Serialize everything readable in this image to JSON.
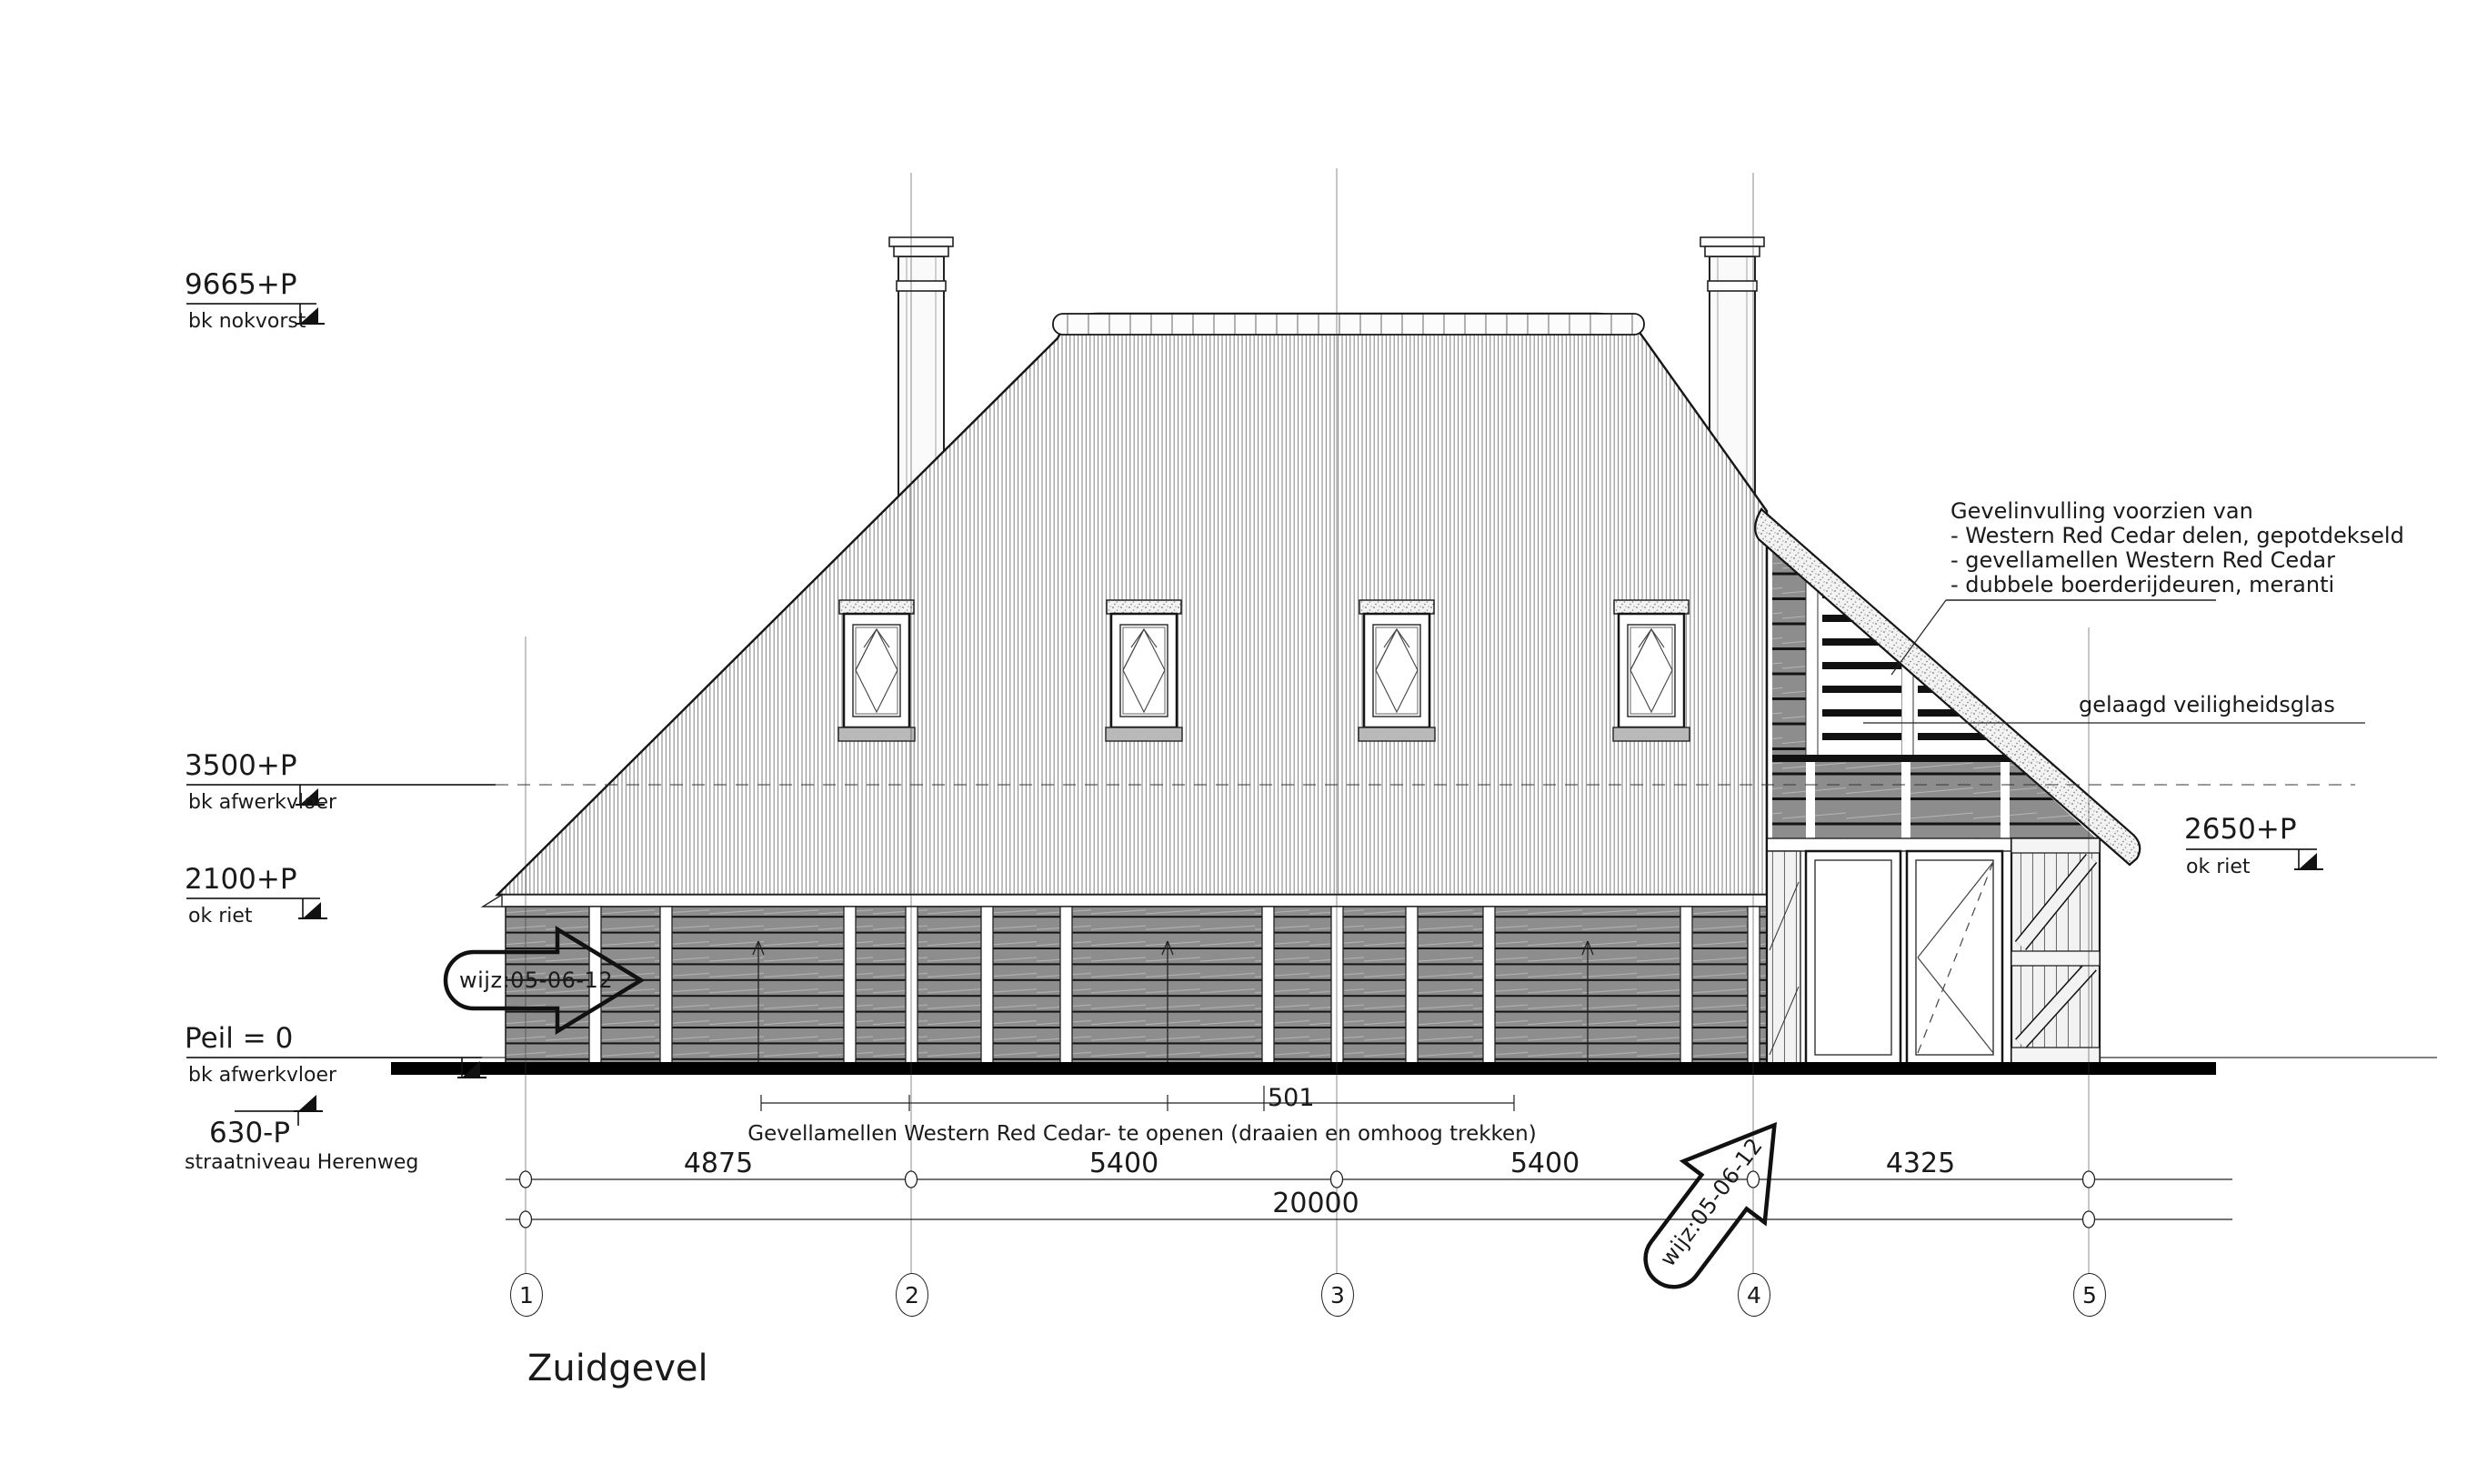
{
  "drawing_title": "Zuidgevel",
  "levels": {
    "nok": {
      "value": "9665+P",
      "label": "bk nokvorst"
    },
    "floor": {
      "value": "3500+P",
      "label": "bk afwerkvloer"
    },
    "okriet": {
      "value": "2100+P",
      "label": "ok riet"
    },
    "peil": {
      "value": "Peil = 0",
      "label": "bk afwerkvloer"
    },
    "street": {
      "value": "630-P",
      "label": "straatniveau Herenweg"
    },
    "okriet_right": {
      "value": "2650+P",
      "label": "ok riet"
    }
  },
  "annotations": {
    "gevelinvulling": [
      "Gevelinvulling voorzien van",
      "- Western Red Cedar delen, gepotdekseld",
      "- gevellamellen Western Red Cedar",
      "- dubbele boerderijdeuren, meranti"
    ],
    "glass": "gelaagd veiligheidsglas",
    "lamellen_ref": "501",
    "lamellen_note": "Gevellamellen Western Red Cedar- te openen  (draaien en omhoog trekken)",
    "revision": "wijz:05-06-12"
  },
  "dimensions": {
    "segments": [
      "4875",
      "5400",
      "5400",
      "4325"
    ],
    "total": "20000"
  },
  "grid_axes": [
    "1",
    "2",
    "3",
    "4",
    "5"
  ],
  "colors": {
    "ink": "#1a1a1a",
    "wall_gray": "#8d8d8d",
    "thatch_line": "#8a8a8a",
    "stipple_bg": "#f3f3f3"
  }
}
